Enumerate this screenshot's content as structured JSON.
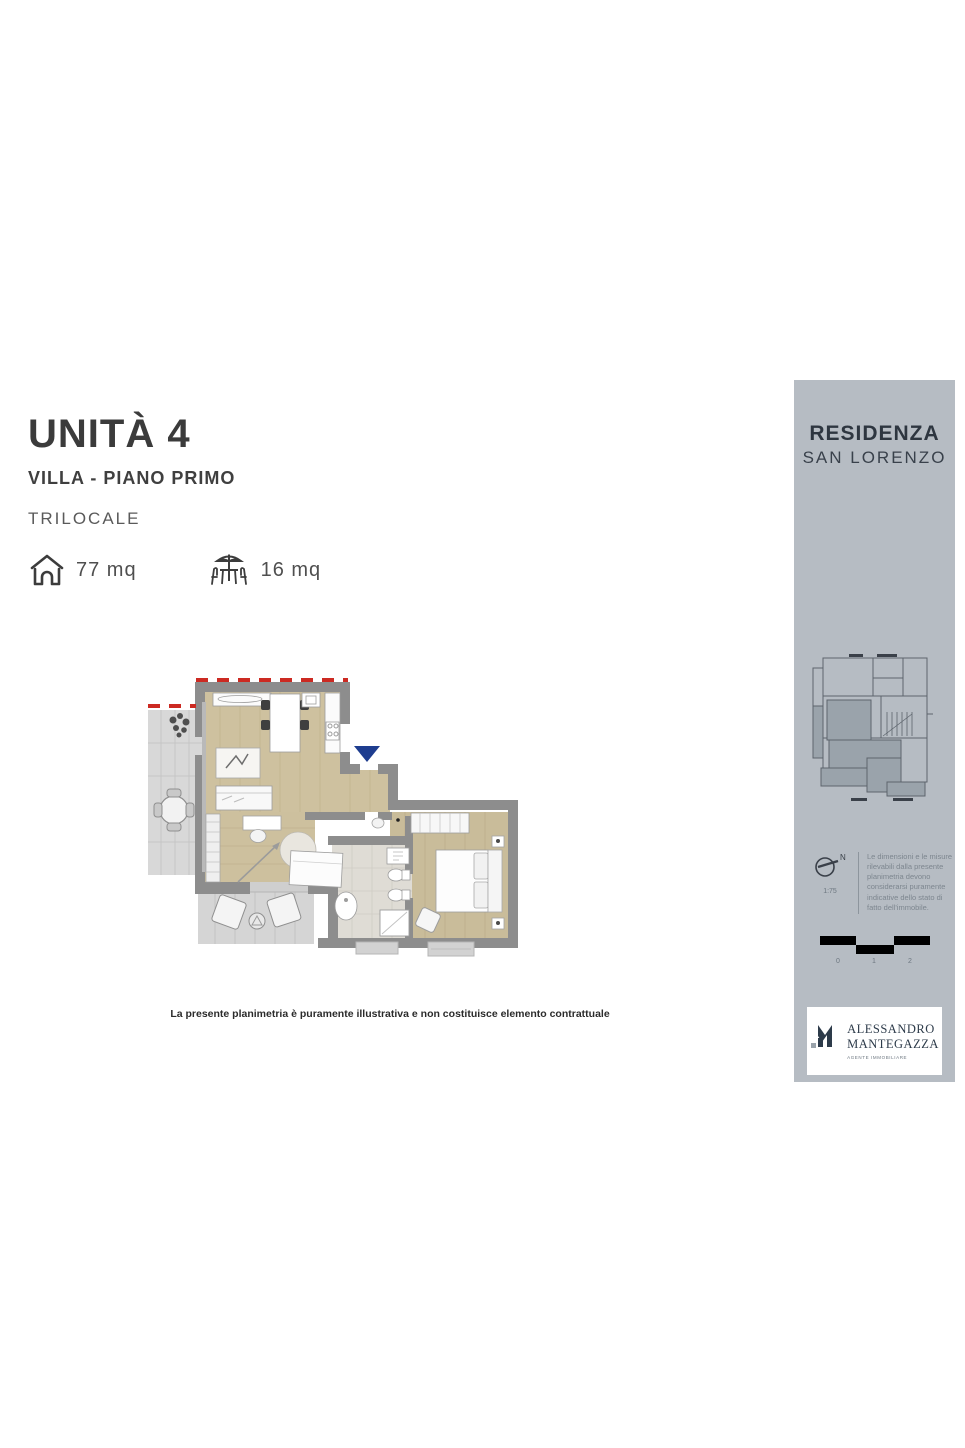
{
  "header": {
    "unit_title": "UNITÀ 4",
    "unit_subtitle": "VILLA - PIANO PRIMO",
    "unit_type": "TRILOCALE",
    "interior_area": "77 mq",
    "exterior_area": "16 mq"
  },
  "plan": {
    "disclaimer": "La presente planimetria è puramente illustrativa e non costituisce elemento contrattuale",
    "entrance_marker_color": "#1e3d8f",
    "boundary_dash_color": "#cc2a22",
    "wall_color": "#8d8d8d",
    "wood_floor_color": "#cec19f",
    "tile_color": "#d8d8d8",
    "bath_color": "#dfdcd5"
  },
  "sidebar": {
    "background_color": "#b6bcc3",
    "residence_title": "RESIDENZA",
    "residence_subtitle": "SAN LORENZO",
    "north_label": "N",
    "scale_ratio": "1:75",
    "note": "Le dimensioni e le misure rilevabili dalla presente planimetria devono considerarsi puramente indicative dello stato di fatto dell'immobile.",
    "scale_labels": [
      "0",
      "1",
      "2"
    ],
    "logo": {
      "name_line1": "ALESSANDRO",
      "name_line2": "MANTEGAZZA",
      "tagline": "AGENTE IMMOBILIARE"
    }
  }
}
